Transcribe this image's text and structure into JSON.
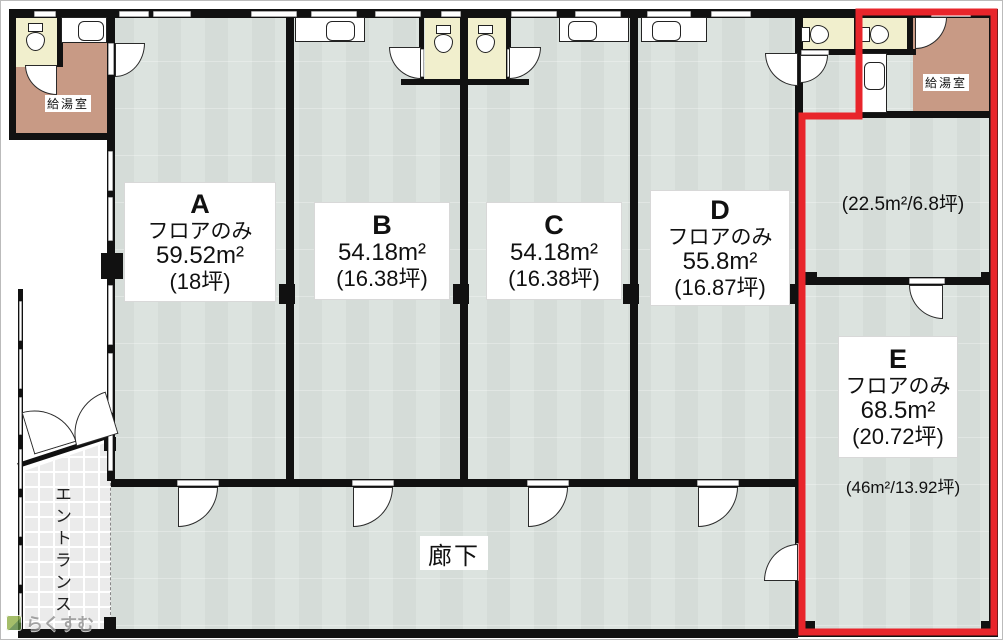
{
  "plan": {
    "rooms": [
      {
        "letter": "A",
        "type_label": "フロアのみ",
        "area_m2": "59.52m²",
        "area_tsubo": "(18坪)"
      },
      {
        "letter": "B",
        "type_label": "",
        "area_m2": "54.18m²",
        "area_tsubo": "(16.38坪)"
      },
      {
        "letter": "C",
        "type_label": "",
        "area_m2": "54.18m²",
        "area_tsubo": "(16.38坪)"
      },
      {
        "letter": "D",
        "type_label": "フロアのみ",
        "area_m2": "55.8m²",
        "area_tsubo": "(16.87坪)"
      },
      {
        "letter": "E",
        "type_label": "フロアのみ",
        "area_m2": "68.5m²",
        "area_tsubo": "(20.72坪)",
        "sub_area": "(46m²/13.92坪)"
      }
    ],
    "upper_right_area": "(22.5m²/6.8坪)",
    "labels": {
      "kitchenette_left": "給湯室",
      "kitchenette_right": "給湯室",
      "corridor": "廊下",
      "entrance": "エントランス"
    },
    "watermark": "らくすむ",
    "colors": {
      "highlight_red": "#e8252b",
      "floor": "#dce3df",
      "kitchenette": "#c89a85",
      "toilet_room": "#f1efcd",
      "wall": "#111111"
    }
  }
}
